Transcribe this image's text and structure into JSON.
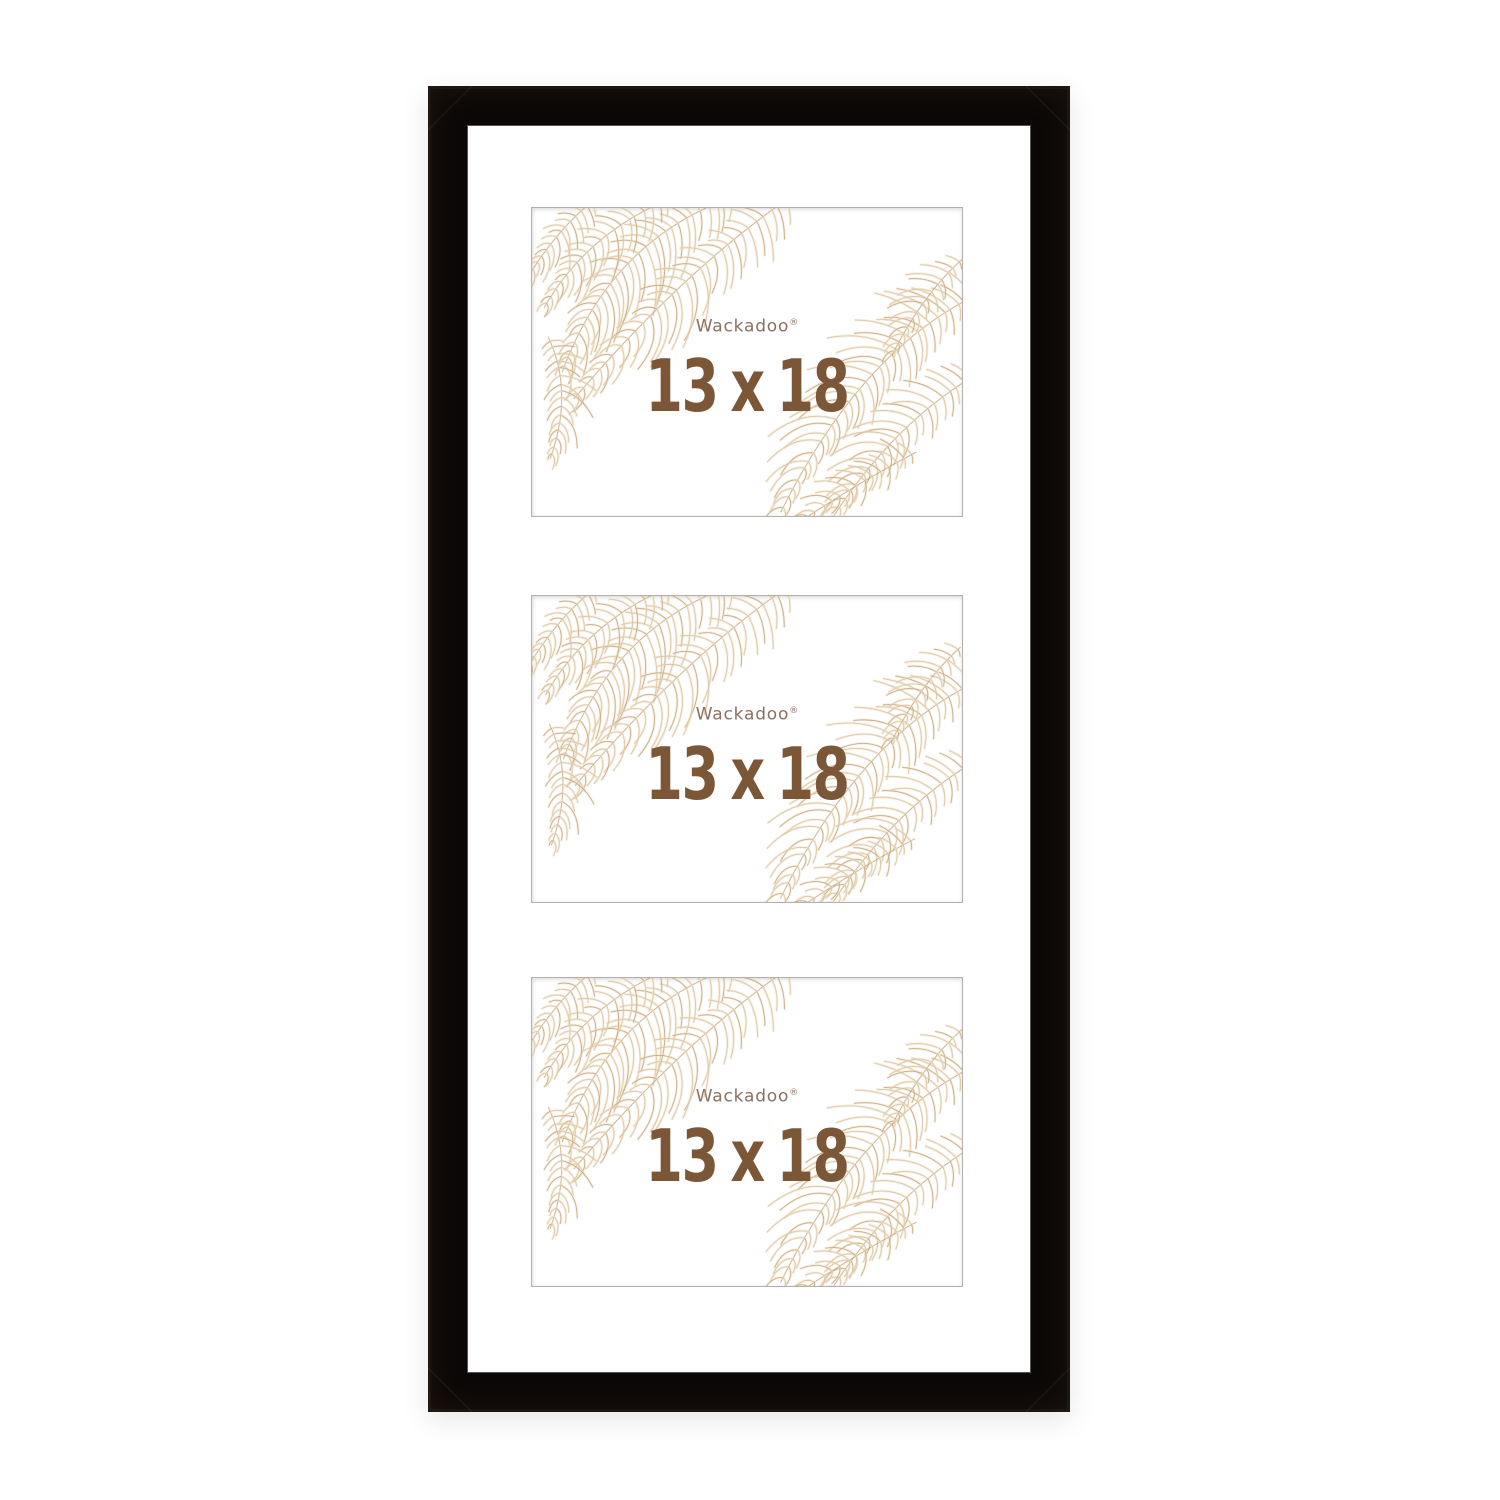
{
  "openings": [
    {
      "brand_label": "Wackadoo",
      "trademark": "®",
      "size_label": "13 x 18"
    },
    {
      "brand_label": "Wackadoo",
      "trademark": "®",
      "size_label": "13 x 18"
    },
    {
      "brand_label": "Wackadoo",
      "trademark": "®",
      "size_label": "13 x 18"
    }
  ],
  "insert_design": {
    "decorations": [
      "pampas-grass-top-left",
      "pampas-grass-bottom-right"
    ]
  },
  "colors": {
    "background": "#ffffff",
    "frame": "#0b0807",
    "mat": "#ffffff",
    "brand_text": "#8a7060",
    "size_text": "#7b5737",
    "feather_light": "#eddfc6",
    "feather_mid": "#d8bd95",
    "feather_dark": "#c09a6b"
  }
}
